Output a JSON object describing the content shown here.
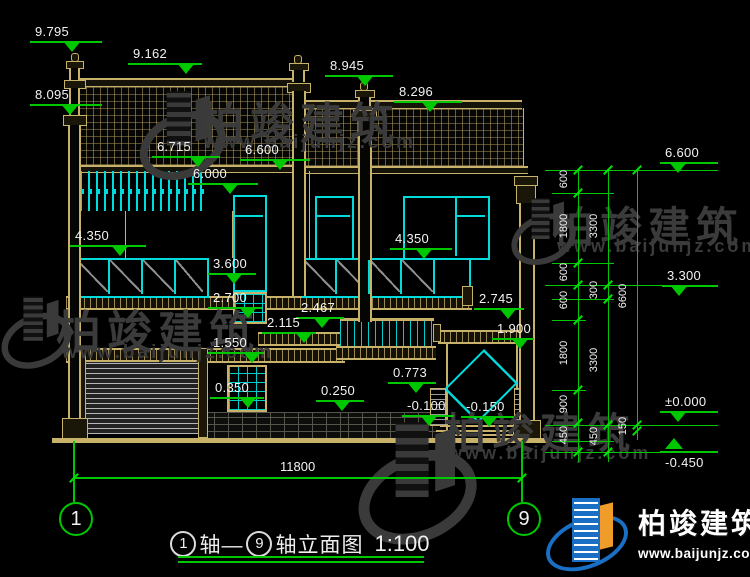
{
  "drawing": {
    "title": {
      "axis_start": "1",
      "axis_end": "9",
      "seg1": "轴—",
      "seg2": "轴立面图",
      "scale": "1:100"
    },
    "bottom_dimension": "11800",
    "axis_bubbles": [
      {
        "label": "1",
        "x": 59
      },
      {
        "label": "9",
        "x": 507
      }
    ]
  },
  "elevation_markers": [
    {
      "label": "9.795",
      "x": 30,
      "y": 41,
      "w": 72,
      "tx": 42,
      "dir": "down"
    },
    {
      "label": "9.162",
      "x": 128,
      "y": 63,
      "w": 74,
      "tx": 58,
      "dir": "down"
    },
    {
      "label": "8.945",
      "x": 325,
      "y": 75,
      "w": 68,
      "tx": 40,
      "dir": "down"
    },
    {
      "label": "8.296",
      "x": 394,
      "y": 101,
      "w": 68,
      "tx": 36,
      "dir": "down"
    },
    {
      "label": "8.095",
      "x": 30,
      "y": 104,
      "w": 72,
      "tx": 40,
      "dir": "down"
    },
    {
      "label": "6.715",
      "x": 152,
      "y": 156,
      "w": 68,
      "tx": 46,
      "dir": "down"
    },
    {
      "label": "6.600",
      "x": 240,
      "y": 159,
      "w": 70,
      "tx": 40,
      "dir": "down"
    },
    {
      "label": "6.000",
      "x": 188,
      "y": 183,
      "w": 70,
      "tx": 42,
      "dir": "down"
    },
    {
      "label": "4.350",
      "x": 70,
      "y": 245,
      "w": 76,
      "tx": 50,
      "dir": "down"
    },
    {
      "label": "3.600",
      "x": 208,
      "y": 273,
      "w": 48,
      "tx": 26,
      "dir": "down"
    },
    {
      "label": "2.700",
      "x": 208,
      "y": 307,
      "w": 54,
      "tx": 40,
      "dir": "down"
    },
    {
      "label": "2.467",
      "x": 296,
      "y": 317,
      "w": 48,
      "tx": 26,
      "dir": "down"
    },
    {
      "label": "2.115",
      "x": 262,
      "y": 332,
      "w": 54,
      "tx": 42,
      "dir": "down"
    },
    {
      "label": "1.550",
      "x": 208,
      "y": 352,
      "w": 56,
      "tx": 44,
      "dir": "down"
    },
    {
      "label": "0.350",
      "x": 210,
      "y": 397,
      "w": 54,
      "tx": 38,
      "dir": "down"
    },
    {
      "label": "0.250",
      "x": 316,
      "y": 400,
      "w": 48,
      "tx": 26,
      "dir": "down"
    },
    {
      "label": "0.773",
      "x": 388,
      "y": 382,
      "w": 48,
      "tx": 28,
      "dir": "down"
    },
    {
      "label": "-0.100",
      "x": 402,
      "y": 415,
      "w": 52,
      "tx": 27,
      "dir": "down"
    },
    {
      "label": "-0.150",
      "x": 461,
      "y": 416,
      "w": 53,
      "tx": 28,
      "dir": "down"
    },
    {
      "label": "1.900",
      "x": 492,
      "y": 338,
      "w": 42,
      "tx": 28,
      "dir": "down"
    },
    {
      "label": "2.745",
      "x": 474,
      "y": 308,
      "w": 50,
      "tx": 34,
      "dir": "down"
    },
    {
      "label": "4.350",
      "x": 390,
      "y": 248,
      "w": 62,
      "tx": 34,
      "dir": "down"
    },
    {
      "label": "6.600",
      "x": 660,
      "y": 162,
      "w": 58,
      "tx": 18,
      "dir": "down"
    },
    {
      "label": "3.300",
      "x": 662,
      "y": 285,
      "w": 56,
      "tx": 17,
      "dir": "down"
    },
    {
      "label": "±0.000",
      "x": 660,
      "y": 411,
      "w": 58,
      "tx": 18,
      "dir": "down"
    },
    {
      "label": "-0.450",
      "x": 660,
      "y": 451,
      "w": 58,
      "tx": 14,
      "dir": "up"
    }
  ],
  "right_dims": {
    "chains": [
      {
        "x": 578,
        "y1": 170,
        "y2": 462,
        "ticks": [
          170,
          193,
          263,
          285,
          320,
          390,
          423,
          452
        ],
        "segments": [
          {
            "y": 181,
            "t": "600"
          },
          {
            "y": 228,
            "t": "1800"
          },
          {
            "y": 274,
            "t": "600"
          },
          {
            "y": 302,
            "t": "600"
          },
          {
            "y": 355,
            "t": "1800"
          },
          {
            "y": 406,
            "t": "900"
          },
          {
            "y": 437,
            "t": "450"
          }
        ]
      },
      {
        "x": 608,
        "y1": 170,
        "y2": 462,
        "ticks": [
          170,
          285,
          299,
          425,
          452
        ],
        "segments": [
          {
            "y": 228,
            "t": "3300"
          },
          {
            "y": 292,
            "t": "300"
          },
          {
            "y": 362,
            "t": "3300"
          },
          {
            "y": 438,
            "t": "450"
          }
        ]
      },
      {
        "x": 637,
        "y1": 170,
        "y2": 440,
        "ticks": [
          170,
          425,
          431
        ],
        "segments": [
          {
            "y": 298,
            "t": "6600"
          },
          {
            "y": 428,
            "t": "150"
          }
        ]
      }
    ],
    "ext_lines": [
      {
        "y": 170,
        "x1": 545,
        "x2": 718
      },
      {
        "y": 193,
        "x1": 552,
        "x2": 614
      },
      {
        "y": 263,
        "x1": 552,
        "x2": 614
      },
      {
        "y": 285,
        "x1": 545,
        "x2": 718
      },
      {
        "y": 299,
        "x1": 552,
        "x2": 614
      },
      {
        "y": 320,
        "x1": 552,
        "x2": 586
      },
      {
        "y": 390,
        "x1": 552,
        "x2": 586
      },
      {
        "y": 425,
        "x1": 545,
        "x2": 718
      },
      {
        "y": 441,
        "x1": 552,
        "x2": 614
      },
      {
        "y": 452,
        "x1": 545,
        "x2": 718
      }
    ]
  },
  "watermark": {
    "cn": "柏竣建筑",
    "url": "www.baijunjz.com"
  },
  "watermark_instances": [
    {
      "icon_x": 138,
      "icon_y": 88,
      "icon_s": 1.6,
      "cn_x": 200,
      "cn_y": 88,
      "cn_s": 44,
      "url_x": 204,
      "url_y": 132,
      "url_s": 19
    },
    {
      "icon_x": 0,
      "icon_y": 294,
      "icon_s": 1.3,
      "cn_x": 56,
      "cn_y": 296,
      "cn_s": 45,
      "url_x": 62,
      "url_y": 342,
      "url_s": 19
    },
    {
      "icon_x": 510,
      "icon_y": 196,
      "icon_s": 1.2,
      "cn_x": 552,
      "cn_y": 194,
      "cn_s": 42,
      "url_x": 557,
      "url_y": 236,
      "url_s": 18
    },
    {
      "icon_x": 356,
      "icon_y": 418,
      "icon_s": 2.2,
      "cn_x": 444,
      "cn_y": 400,
      "cn_s": 42,
      "url_x": 448,
      "url_y": 443,
      "url_s": 18
    }
  ],
  "brand_logo": {
    "cn": "柏竣建筑",
    "url": "www.baijunjz.com"
  },
  "colors": {
    "annotation_green": "#00c800",
    "structure_tan": "#c8b26a",
    "glass_cyan": "#00dcdc",
    "text_white": "#f2f2f2",
    "watermark_gray": "#3b3b3b",
    "logo_blue": "#1a6fc4",
    "logo_orange": "#f09c28"
  }
}
